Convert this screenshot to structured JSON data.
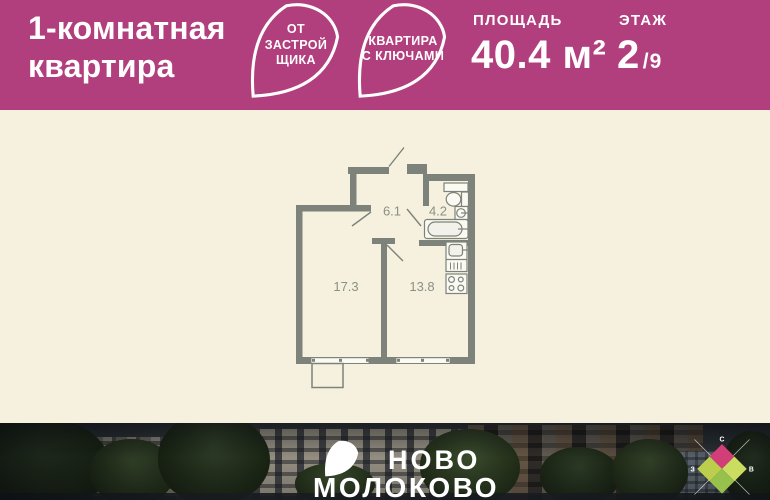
{
  "header": {
    "title_line1": "1-комнатная",
    "title_line2": "квартира",
    "badge_developer": {
      "line1": "ОТ",
      "line2": "ЗАСТРОЙ",
      "line3": "ЩИКА"
    },
    "badge_keys": {
      "line1": "КВАРТИРА",
      "line2": "С КЛЮЧАМИ"
    },
    "area_label": "ПЛОЩАДЬ",
    "area_value": "40.4 м²",
    "floor_label": "ЭТАЖ",
    "floor_value": "2",
    "floor_total": "/9"
  },
  "floor_plan": {
    "hallway_area": "6.1",
    "bathroom_area": "4.2",
    "living_room_area": "17.3",
    "kitchen_area": "13.8"
  },
  "footer": {
    "logo_line1": "НОВО",
    "logo_line2": "МОЛОКОВО",
    "compass": {
      "north": "С",
      "west": "З",
      "east": "В"
    }
  },
  "colors": {
    "accent_magenta": "#b23f7d",
    "cream_background": "#f6f1de",
    "wall_gray": "#7d837a",
    "compass_pink": "#d23f78",
    "compass_green_left": "#bccf4d",
    "compass_green_right": "#cbdd60",
    "compass_green_bottom": "#97c04c"
  }
}
